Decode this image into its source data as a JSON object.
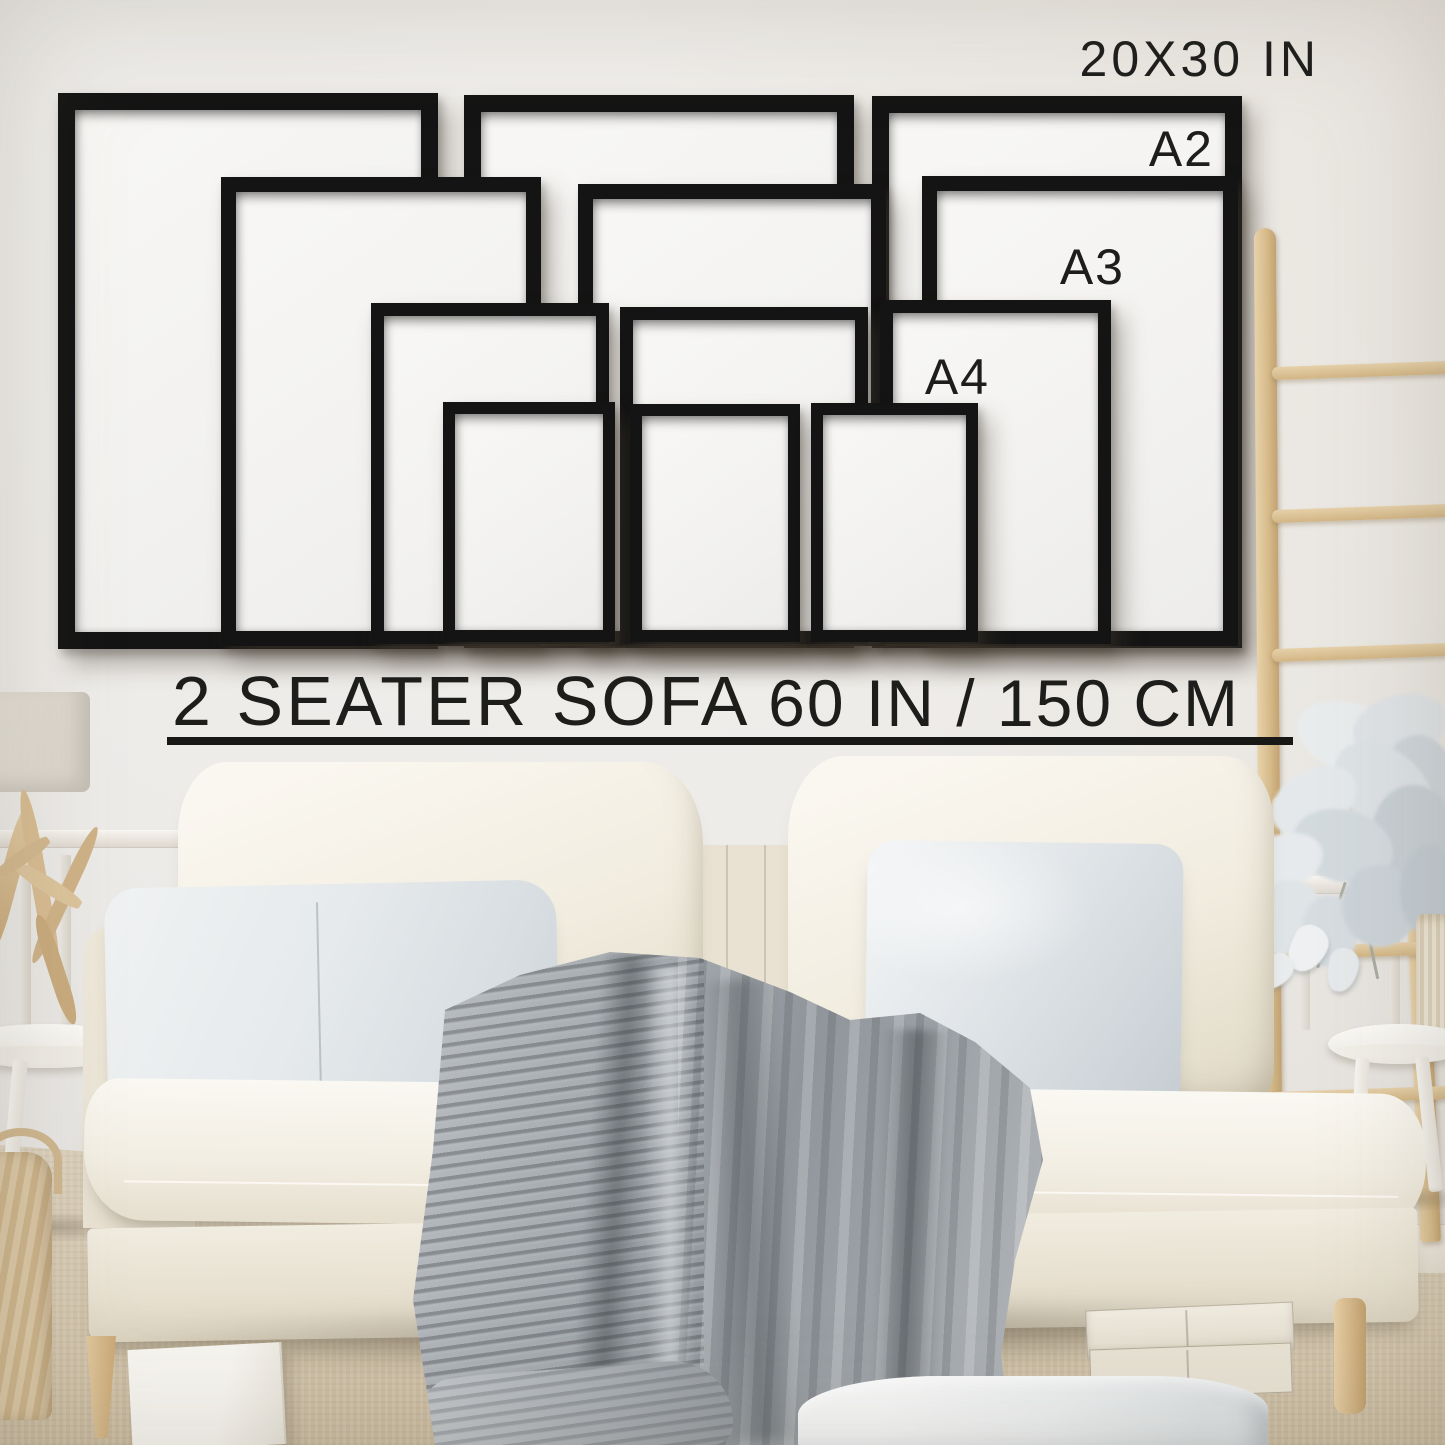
{
  "image_type": "wall art size guide photograph",
  "labels": {
    "size_top": "20X30 IN",
    "a2": "A2",
    "a3": "A3",
    "a4": "A4",
    "sofa": "2 SEATER SOFA",
    "sofa_width": "60 IN / 150 CM"
  },
  "frames": [
    {
      "size": "20X30 IN",
      "column": "left"
    },
    {
      "size": "20X30 IN",
      "column": "middle"
    },
    {
      "size": "20X30 IN",
      "column": "right"
    },
    {
      "size": "A2",
      "column": "left"
    },
    {
      "size": "A2",
      "column": "middle"
    },
    {
      "size": "A2",
      "column": "right"
    },
    {
      "size": "A3",
      "column": "left"
    },
    {
      "size": "A3",
      "column": "middle"
    },
    {
      "size": "A3",
      "column": "right"
    },
    {
      "size": "A4",
      "column": "left"
    },
    {
      "size": "A4",
      "column": "middle"
    },
    {
      "size": "A4",
      "column": "right"
    }
  ],
  "colors": {
    "frame": "#141414",
    "text": "#1d1d1b",
    "wall": "#eceae7",
    "sofa_cream": "#f3efe6",
    "pillow_gray": "#e9eced",
    "blanket_gray": "#9aa0a5",
    "wood_tan": "#d9c29a",
    "rug_beige": "#d8cbb5"
  },
  "scene_objects": [
    "wall-frames",
    "ladder",
    "plant",
    "vase",
    "side-tables",
    "lamp",
    "driftwood-decor",
    "sofa",
    "back-cushions",
    "throw-pillows",
    "knit-blanket",
    "storage-boxes",
    "floor-pillow",
    "basket",
    "rug"
  ]
}
